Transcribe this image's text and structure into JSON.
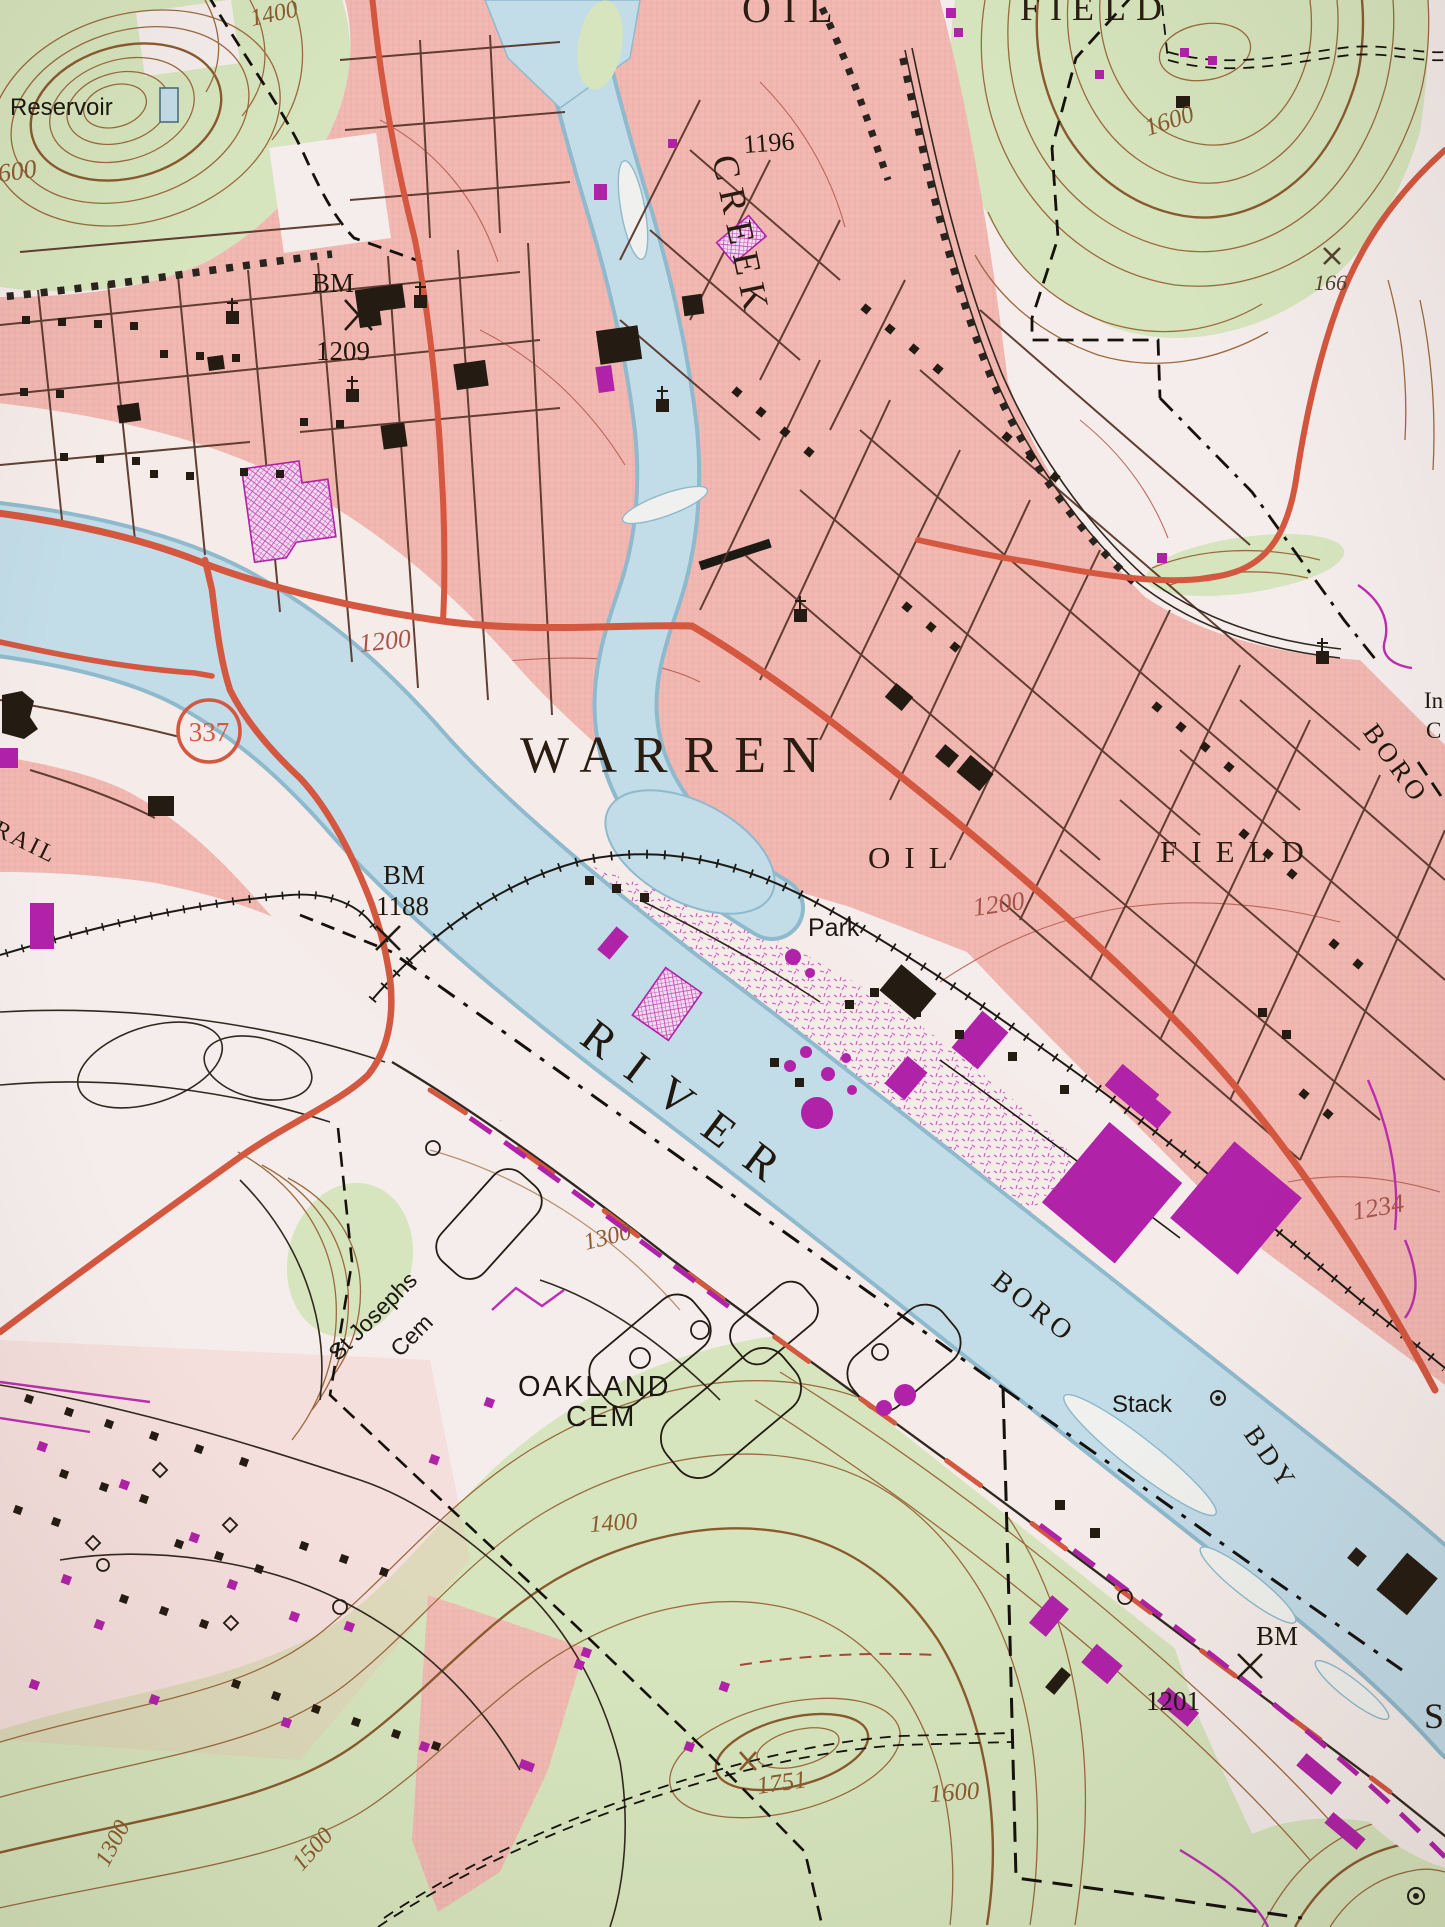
{
  "map": {
    "kind": "USGS topographic quadrangle (photo of paper map), Warren PA area",
    "labels": {
      "warren": "WARREN",
      "creek": "CREEK",
      "river": "RIVER",
      "oil_field_top": {
        "oil": "OIL",
        "field": "FIELD"
      },
      "oil_field": {
        "oil": "OIL",
        "field": "FIELD"
      },
      "reservoir": "Reservoir",
      "park": "Park",
      "stack": "Stack",
      "rail": "RAIL",
      "boro_north": "BORO",
      "boro_south": "BORO",
      "bdy": "BDY",
      "oakland": {
        "line1": "OAKLAND",
        "line2": "CEM"
      },
      "st_josephs": {
        "line1": "St Josephs",
        "line2": "Cem"
      },
      "edge_fragments": {
        "in_w": "In",
        "c_w": "C",
        "s_w": "S"
      }
    },
    "benchmarks": {
      "bm1209": {
        "label": "BM",
        "elev": "1209"
      },
      "bm1188": {
        "label": "BM",
        "elev": "1188"
      },
      "bm1201": {
        "label": "BM",
        "elev": "1201"
      }
    },
    "spots": {
      "s1196": "1196",
      "s1751": "1751",
      "s166": "166"
    },
    "contour_labels": {
      "c1400_nw": "1400",
      "c1600_w": "1600",
      "c1600_ne": "1600",
      "c1200_bridge": "1200",
      "c1200_oilfield": "1200",
      "c1234": "1234",
      "c1300_cem": "1300",
      "c1400_cem": "1400",
      "c1300_sw": "1300",
      "c1500_sw": "1500",
      "c1600_s": "1600"
    },
    "route_shield": {
      "number": "337"
    },
    "colors": {
      "urban_pink": "#f2b9b3",
      "woodland_green": "#d6e5bd",
      "water_blue": "#c2dce8",
      "water_edge": "#8fb9cc",
      "contour_brown": "#9b6a3e",
      "contour_red_brown": "#a5544a",
      "road_red": "#d4573f",
      "revision_purple": "#b022a8",
      "ink_black": "#241b12",
      "paper_white": "#f5edec"
    }
  }
}
